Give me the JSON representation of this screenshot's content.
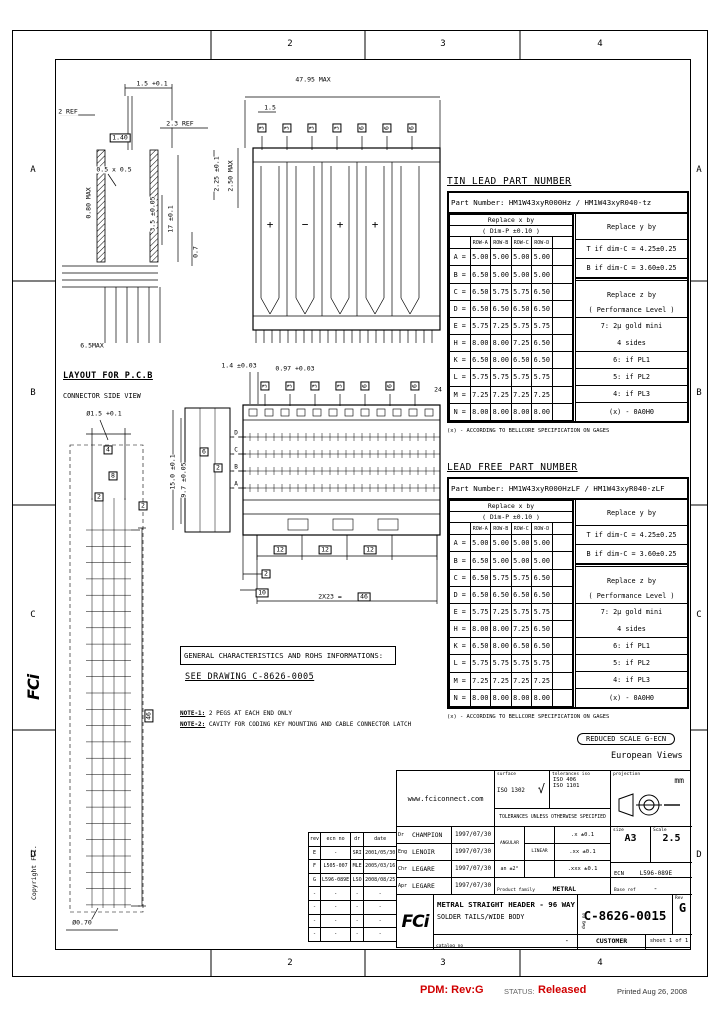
{
  "frame": {
    "zones_top": [
      "2",
      "3",
      "4"
    ],
    "zones_bottom": [
      "2",
      "3",
      "4"
    ],
    "zones_left": [
      "A",
      "B",
      "C",
      "D"
    ],
    "zones_right": [
      "A",
      "B",
      "C",
      "D"
    ]
  },
  "footer": {
    "pdm": "PDM: Rev:G",
    "status_label": "STATUS:",
    "status_value": "Released",
    "printed": "Printed Aug 26, 2008"
  },
  "margin": {
    "copyright": "Copyright FCI.",
    "logo": "FCi"
  },
  "icons": {
    "surface_check": "√"
  },
  "headings": {
    "pcb_layout_title": "LAYOUT FOR P.C.B",
    "pcb_layout_subtitle": "CONNECTOR SIDE VIEW"
  },
  "notes": {
    "general_box": "GENERAL CHARACTERISTICS AND ROHS INFORMATIONS:",
    "see_drawing": "SEE DRAWING C-8626-0005",
    "note1_label": "NOTE-1:",
    "note1": " 2 PEGS AT EACH END ONLY",
    "note2_label": "NOTE-2:",
    "note2": " CAVITY FOR CODING KEY MOUNTING AND CABLE CONNECTOR LATCH",
    "reduced_scale": "REDUCED SCALE G-ECN",
    "euro_views": "European Views"
  },
  "tables": {
    "tin_lead": {
      "title": "TIN LEAD PART NUMBER",
      "part_number_line": "Part Number: HM1W43xyR000Hz / HM1W43xyR040-tz",
      "x_header": "Replace x by",
      "x_header2": "( Dim-P ±0.10 )",
      "row_headers": [
        "ROW-A",
        "ROW-B",
        "ROW-C",
        "ROW-D"
      ],
      "rows": [
        [
          "A =",
          "5.00",
          "5.00",
          "5.00",
          "5.00"
        ],
        [
          "B =",
          "6.50",
          "5.00",
          "5.00",
          "5.00"
        ],
        [
          "C =",
          "6.50",
          "5.75",
          "5.75",
          "6.50"
        ],
        [
          "D =",
          "6.50",
          "6.50",
          "6.50",
          "6.50"
        ],
        [
          "E =",
          "5.75",
          "7.25",
          "5.75",
          "5.75"
        ],
        [
          "H =",
          "8.00",
          "8.00",
          "7.25",
          "6.50"
        ],
        [
          "K =",
          "6.50",
          "8.00",
          "6.50",
          "6.50"
        ],
        [
          "L =",
          "5.75",
          "5.75",
          "5.75",
          "5.75"
        ],
        [
          "M =",
          "7.25",
          "7.25",
          "7.25",
          "7.25"
        ],
        [
          "N =",
          "8.00",
          "8.00",
          "8.00",
          "8.00"
        ]
      ],
      "yz_rows": [
        "Replace y by",
        "T if dim-C = 4.25±0.25",
        "B if dim-C = 3.60±0.25",
        "",
        "Replace z by",
        "( Performance Level )",
        "7: 2μ gold mini",
        "4 sides",
        "6: if PL1",
        "5: if PL2",
        "4: if PL3",
        "(x) - 0A0H0"
      ],
      "note": "(x) - ACCORDING TO BELLCORE SPECIFICATION ON GAGES"
    },
    "lead_free": {
      "title": "LEAD FREE PART NUMBER",
      "part_number_line": "Part Number: HM1W43xyR000HzLF / HM1W43xyR040-zLF",
      "x_header": "Replace x by",
      "x_header2": "( Dim-P ±0.10 )",
      "row_headers": [
        "ROW-A",
        "ROW-B",
        "ROW-C",
        "ROW-D"
      ],
      "rows": [
        [
          "A =",
          "5.00",
          "5.00",
          "5.00",
          "5.00"
        ],
        [
          "B =",
          "6.50",
          "5.00",
          "5.00",
          "5.00"
        ],
        [
          "C =",
          "6.50",
          "5.75",
          "5.75",
          "6.50"
        ],
        [
          "D =",
          "6.50",
          "6.50",
          "6.50",
          "6.50"
        ],
        [
          "E =",
          "5.75",
          "7.25",
          "5.75",
          "5.75"
        ],
        [
          "H =",
          "8.00",
          "8.00",
          "7.25",
          "6.50"
        ],
        [
          "K =",
          "6.50",
          "8.00",
          "6.50",
          "6.50"
        ],
        [
          "L =",
          "5.75",
          "5.75",
          "5.75",
          "5.75"
        ],
        [
          "M =",
          "7.25",
          "7.25",
          "7.25",
          "7.25"
        ],
        [
          "N =",
          "8.00",
          "8.00",
          "8.00",
          "8.00"
        ]
      ],
      "yz_rows": [
        "Replace y by",
        "T if dim-C = 4.25±0.25",
        "B if dim-C = 3.60±0.25",
        "",
        "Replace z by",
        "( Performance Level )",
        "7: 2μ gold mini",
        "4 sides",
        "6: if PL1",
        "5: if PL2",
        "4: if PL3",
        "(x) - 0A0H0"
      ],
      "note": "(x) - ACCORDING TO BELLCORE SPECIFICATION ON GAGES"
    }
  },
  "title_block": {
    "website": "www.fciconnect.com",
    "surface_label": "surface",
    "surface_std": "ISO 1302",
    "tol_label": "tolerances iso",
    "tol_std1": "ISO 406",
    "tol_std2": "ISO 1101",
    "projection_label": "projection",
    "units": "mm",
    "tol_note": "TOLERANCES UNLESS OTHERWISE SPECIFIED",
    "signatures": [
      {
        "role": "Dr",
        "name": "CHAMPION",
        "date": "1997/07/30"
      },
      {
        "role": "Eng",
        "name": "LENOIR",
        "date": "1997/07/30"
      },
      {
        "role": "Chr",
        "name": "LEGARE",
        "date": "1997/07/30"
      },
      {
        "role": "Apr",
        "name": "LEGARE",
        "date": "1997/07/30"
      }
    ],
    "angular_label": "ANGULAR",
    "linear_label": "LINEAR",
    "angular_tol": "an ±2°",
    "linear_tols": [
      ".x ±0.1",
      ".xx ±0.1",
      ".xxx ±0.1"
    ],
    "size_label": "size",
    "size": "A3",
    "scale_label": "Scale",
    "scale": "2.5",
    "ecn_label": "ECN",
    "ecn": "L596-089E",
    "family_label": "Product family",
    "family": "METRAL",
    "base_label": "Base ref",
    "base": "-",
    "logo": "FCi",
    "title_line1": "METRAL STRAIGHT HEADER - 96 WAY",
    "title_line2": "SOLDER TAILS/WIDE BODY",
    "dwg_label": "dwg no",
    "drawing_number": "C-8626-0015",
    "rev_label": "Rev",
    "rev": "G",
    "catalog_label": "catalog no",
    "catalog": "-",
    "customer": "CUSTOMER",
    "sheet": "sheet 1 of 1"
  },
  "revisions": {
    "headers": [
      "rev",
      "ecn no",
      "dr",
      "date"
    ],
    "rows": [
      [
        "E",
        "-",
        "SRI",
        "2001/05/30"
      ],
      [
        "F",
        "L505-007",
        "MLE",
        "2005/03/16"
      ],
      [
        "G",
        "L596-089E",
        "LSO",
        "2008/08/25"
      ],
      [
        "-",
        "-",
        "-",
        "-"
      ],
      [
        "-",
        "-",
        "-",
        "-"
      ],
      [
        "-",
        "-",
        "-",
        "-"
      ],
      [
        "-",
        "-",
        "-",
        "-"
      ]
    ]
  },
  "balloons": {
    "values": [
      "3",
      "3",
      "3",
      "3",
      "6",
      "6",
      "6"
    ],
    "rows": [
      {
        "x0": 262,
        "y": 128,
        "step": 25
      },
      {
        "x0": 265,
        "y": 386,
        "step": 25
      }
    ]
  },
  "dim_labels": [
    {
      "n": "dim-pitch-tol",
      "t": "1.5 +0.1",
      "x": 152,
      "y": 84
    },
    {
      "n": "dim-2-ref",
      "t": "2 REF",
      "x": 68,
      "y": 112
    },
    {
      "n": "dim-2-3-ref",
      "t": "2.3 REF",
      "x": 180,
      "y": 124
    },
    {
      "n": "dim-1-40",
      "t": "1.40",
      "x": 120,
      "y": 138,
      "box": true
    },
    {
      "n": "dim-chamfer",
      "t": "0.5 x 0.5",
      "x": 114,
      "y": 170
    },
    {
      "n": "dim-0-80-max",
      "t": "0.80 MAX",
      "x": 89,
      "y": 203,
      "rot": -90
    },
    {
      "n": "dim-3-5",
      "t": "3.5 ±0.05",
      "x": 153,
      "y": 214,
      "rot": -90
    },
    {
      "n": "dim-17",
      "t": "17 ±0.1",
      "x": 171,
      "y": 219,
      "rot": -90
    },
    {
      "n": "dim-0-7",
      "t": "0.7",
      "x": 196,
      "y": 252,
      "rot": -90
    },
    {
      "n": "dim-2-25",
      "t": "2.25 ±0.1",
      "x": 217,
      "y": 174,
      "rot": -90
    },
    {
      "n": "dim-6-5-max",
      "t": "6.5MAX",
      "x": 92,
      "y": 346
    },
    {
      "n": "dim-overall-width",
      "t": "47.95 MAX",
      "x": 313,
      "y": 80
    },
    {
      "n": "dim-pitch",
      "t": "1.5",
      "x": 270,
      "y": 108
    },
    {
      "n": "dim-2-50-max",
      "t": "2.50 MAX",
      "x": 231,
      "y": 176,
      "rot": -90
    },
    {
      "n": "polarity-plus-1",
      "t": "+",
      "x": 270,
      "y": 225,
      "size": 11
    },
    {
      "n": "polarity-minus",
      "t": "−",
      "x": 305,
      "y": 225,
      "size": 11
    },
    {
      "n": "polarity-plus-2",
      "t": "+",
      "x": 340,
      "y": 225,
      "size": 11
    },
    {
      "n": "polarity-plus-3",
      "t": "+",
      "x": 375,
      "y": 225,
      "size": 11
    },
    {
      "n": "dim-1-4",
      "t": "1.4 ±0.03",
      "x": 239,
      "y": 366
    },
    {
      "n": "dim-0-97",
      "t": "0.97 +0.03",
      "x": 295,
      "y": 369
    },
    {
      "n": "count-24",
      "t": "24",
      "x": 438,
      "y": 390
    },
    {
      "n": "dim-15-0",
      "t": "15.0 ±0.1",
      "x": 173,
      "y": 472,
      "rot": -90
    },
    {
      "n": "dim-9-7",
      "t": "9.7 ±0.05",
      "x": 184,
      "y": 480,
      "rot": -90
    },
    {
      "n": "balloon-6",
      "t": "6",
      "x": 204,
      "y": 452,
      "box": true
    },
    {
      "n": "balloon-2",
      "t": "2",
      "x": 218,
      "y": 468,
      "box": true
    },
    {
      "n": "row-letter-d",
      "t": "D",
      "x": 236,
      "y": 434,
      "size": 6
    },
    {
      "n": "row-letter-c",
      "t": "C",
      "x": 236,
      "y": 451,
      "size": 6
    },
    {
      "n": "row-letter-b",
      "t": "B",
      "x": 236,
      "y": 468,
      "size": 6
    },
    {
      "n": "row-letter-a",
      "t": "A",
      "x": 236,
      "y": 485,
      "size": 6
    },
    {
      "n": "dim-12-1",
      "t": "12",
      "x": 280,
      "y": 550,
      "box": true
    },
    {
      "n": "dim-12-2",
      "t": "12",
      "x": 325,
      "y": 550,
      "box": true
    },
    {
      "n": "dim-12-3",
      "t": "12",
      "x": 370,
      "y": 550,
      "box": true
    },
    {
      "n": "dim-2-end",
      "t": "2",
      "x": 266,
      "y": 574,
      "box": true
    },
    {
      "n": "dim-10",
      "t": "10",
      "x": 262,
      "y": 593,
      "box": true
    },
    {
      "n": "dim-2x23",
      "t": "2X23 =",
      "x": 330,
      "y": 597
    },
    {
      "n": "dim-46-box",
      "t": "46",
      "x": 364,
      "y": 597,
      "box": true
    },
    {
      "n": "hole-dia-1-5",
      "t": "Ø1.5 +0.1",
      "x": 104,
      "y": 414
    },
    {
      "n": "balloon-4-pcb",
      "t": "4",
      "x": 108,
      "y": 450,
      "box": true
    },
    {
      "n": "balloon-8-pcb",
      "t": "8",
      "x": 113,
      "y": 476,
      "box": true
    },
    {
      "n": "balloon-2-pcb-1",
      "t": "2",
      "x": 99,
      "y": 497,
      "box": true
    },
    {
      "n": "balloon-2-pcb-2",
      "t": "2",
      "x": 143,
      "y": 506,
      "box": true
    },
    {
      "n": "dim-46-vert",
      "t": "46",
      "x": 149,
      "y": 716,
      "rot": -90,
      "box": true
    },
    {
      "n": "hole-dia-0-70",
      "t": "Ø0.70",
      "x": 82,
      "y": 923
    }
  ]
}
